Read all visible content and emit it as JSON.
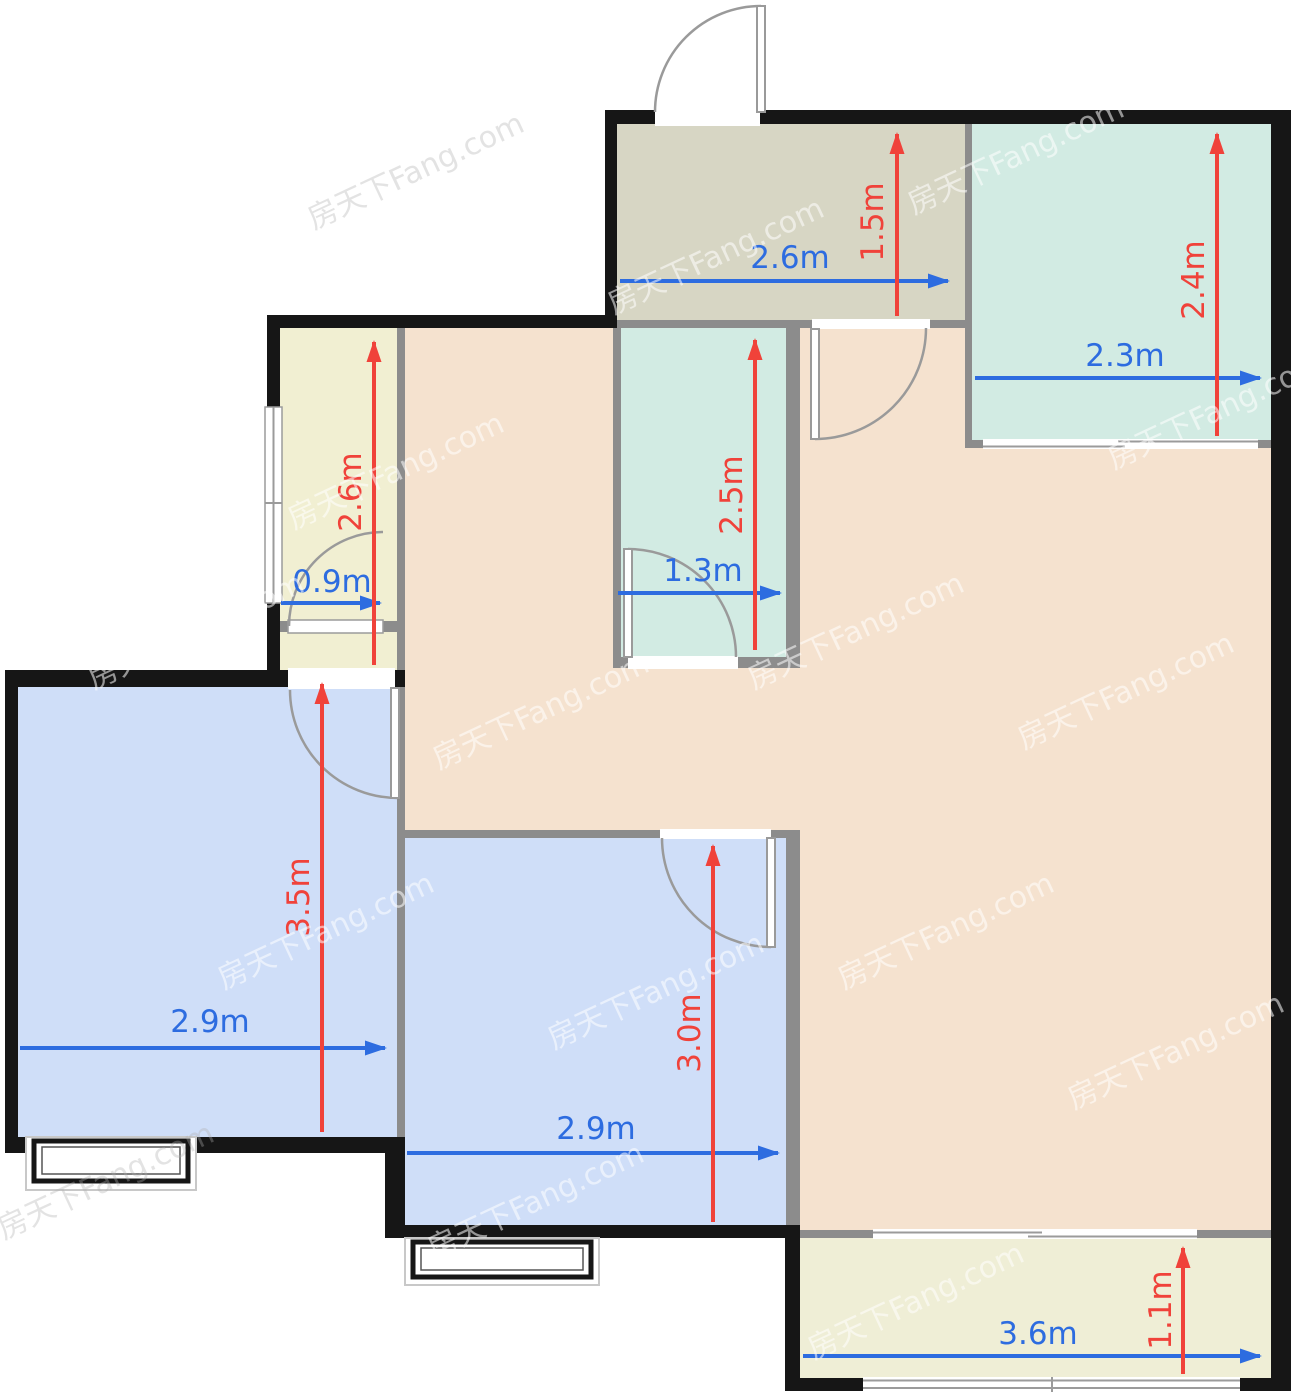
{
  "watermark": {
    "text": "房天下Fang.com"
  },
  "colors": {
    "wall_dark": "#161616",
    "wall_gray": "#8c8c8c",
    "room_tan": "#f5e2cf",
    "room_entry": "#d7d6c4",
    "room_teal": "#d2ebe3",
    "room_yellow": "#f1efd2",
    "room_blue": "#cfdef8",
    "room_balcony": "#efeed6",
    "dim_red": "#f0423a",
    "dim_blue": "#2d6ce0"
  },
  "dims": {
    "h": [
      {
        "id": "entry-width",
        "label": "2.6m"
      },
      {
        "id": "bedroom-tr-width",
        "label": "2.3m"
      },
      {
        "id": "closet-width",
        "label": "0.9m"
      },
      {
        "id": "bathroom-width",
        "label": "1.3m"
      },
      {
        "id": "bedroom-left-width",
        "label": "2.9m"
      },
      {
        "id": "bedroom-center-width",
        "label": "2.9m"
      },
      {
        "id": "balcony-width",
        "label": "3.6m"
      }
    ],
    "v": [
      {
        "id": "entry-depth",
        "label": "1.5m"
      },
      {
        "id": "bedroom-tr-depth",
        "label": "2.4m"
      },
      {
        "id": "closet-depth",
        "label": "2.6m"
      },
      {
        "id": "bathroom-depth",
        "label": "2.5m"
      },
      {
        "id": "bedroom-left-depth",
        "label": "3.5m"
      },
      {
        "id": "bedroom-center-depth",
        "label": "3.0m"
      },
      {
        "id": "balcony-depth",
        "label": "1.1m"
      }
    ]
  }
}
